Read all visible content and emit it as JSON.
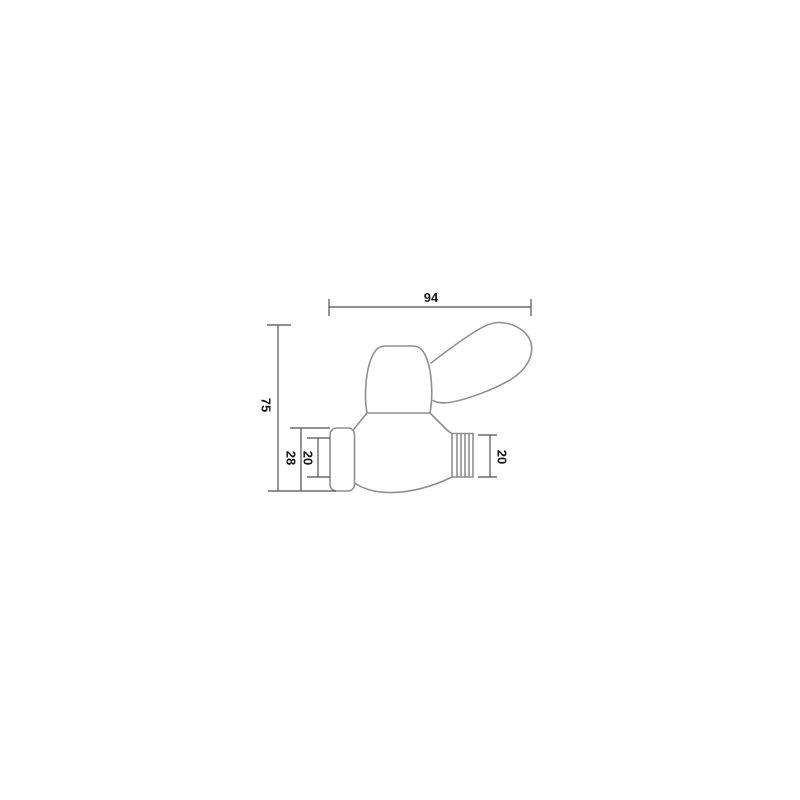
{
  "canvas": {
    "background": "#ffffff"
  },
  "colors": {
    "outline": "#8f8f8f",
    "dimension_lines": "#4f4f4f",
    "dimension_text": "#161616"
  },
  "drawing": {
    "dimensions": {
      "overall_width": "94",
      "overall_height": "75",
      "inlet_outer_height": "28",
      "inlet_inner_height": "20",
      "outlet_thread_height": "20"
    }
  }
}
